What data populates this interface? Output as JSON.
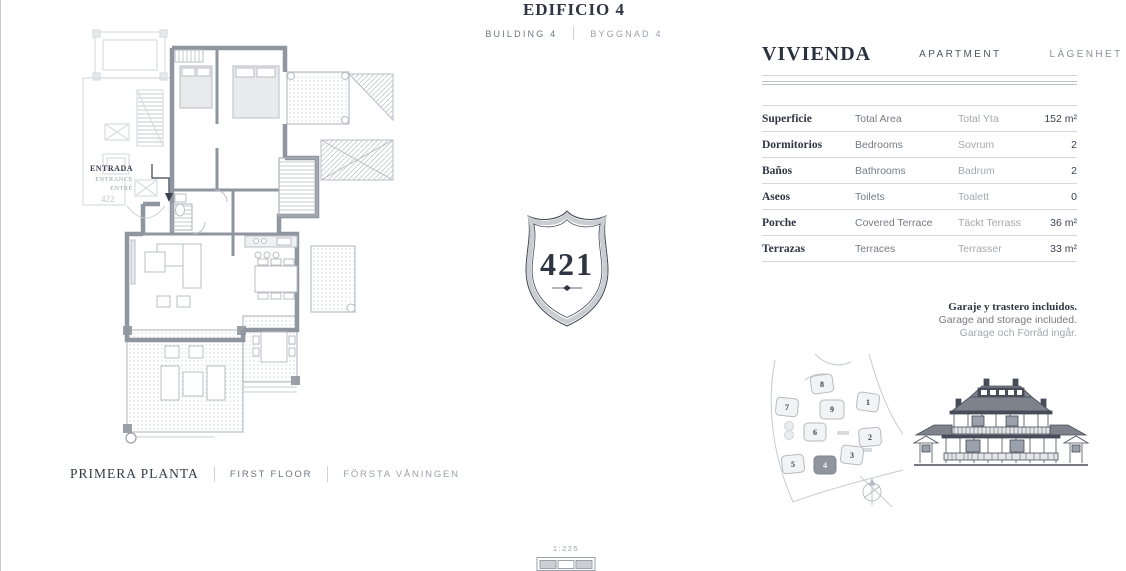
{
  "header": {
    "title": "EDIFICIO 4",
    "en": "BUILDING 4",
    "sv": "BYGGNAD 4"
  },
  "badge": {
    "number": "421"
  },
  "plan": {
    "entrance": {
      "es": "ENTRADA",
      "en": "ENTRANCE",
      "sv": "ENTRÉ"
    },
    "adjacent_unit": "422",
    "floor": {
      "es": "PRIMERA PLANTA",
      "en": "FIRST FLOOR",
      "sv": "FÖRSTA VÅNINGEN"
    },
    "scale": "1:225"
  },
  "details": {
    "title": {
      "es": "VIVIENDA",
      "en": "APARTMENT",
      "sv": "LÄGENHET"
    },
    "rows": [
      {
        "es": "Superficie",
        "en": "Total Area",
        "sv": "Total Yta",
        "value": "152 m²"
      },
      {
        "es": "Dormitorios",
        "en": "Bedrooms",
        "sv": "Sovrum",
        "value": "2"
      },
      {
        "es": "Baños",
        "en": "Bathrooms",
        "sv": "Badrum",
        "value": "2"
      },
      {
        "es": "Aseos",
        "en": "Toilets",
        "sv": "Toalett",
        "value": "0"
      },
      {
        "es": "Porche",
        "en": "Covered Terrace",
        "sv": "Täckt Terrass",
        "value": "36 m²"
      },
      {
        "es": "Terrazas",
        "en": "Terraces",
        "sv": "Terrasser",
        "value": "33 m²"
      }
    ],
    "note": {
      "es": "Garaje y trastero incluidos.",
      "en": "Garage and storage included.",
      "sv": "Garage och Förråd ingår."
    }
  },
  "site_plan": {
    "buildings": [
      "1",
      "2",
      "3",
      "4",
      "5",
      "6",
      "7",
      "8",
      "9"
    ],
    "highlighted_building": "4"
  },
  "colors": {
    "ink": "#2f3643",
    "muted": "#757c85",
    "light": "#a3a9b0",
    "wall": "#8f96a0",
    "faded": "#d9dce0",
    "rule": "#d6d8da"
  }
}
